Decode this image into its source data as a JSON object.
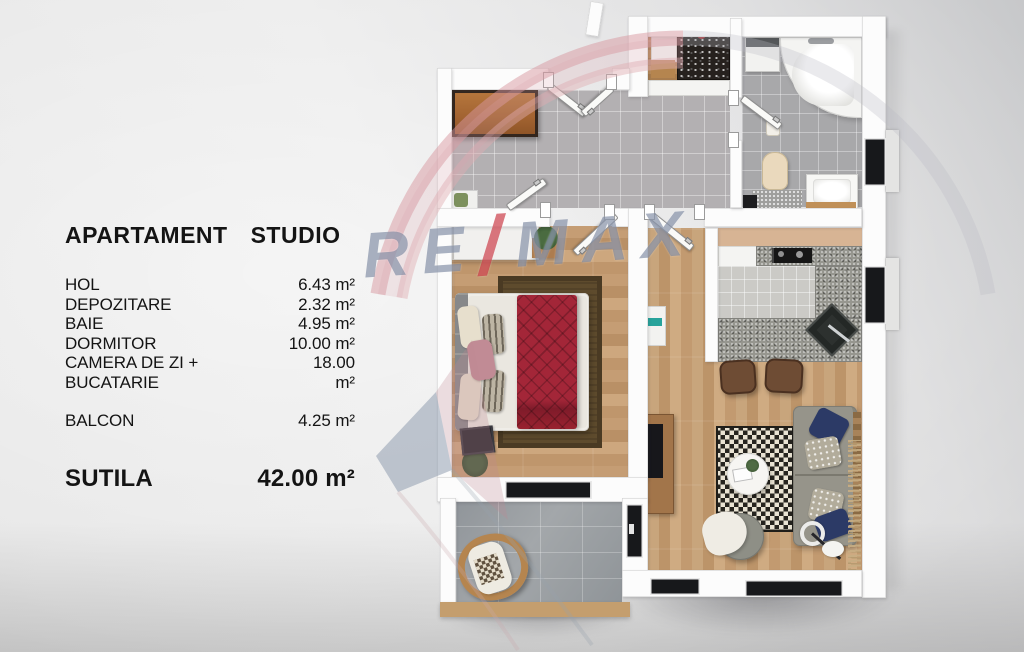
{
  "legend": {
    "title": {
      "word1": "APARTAMENT",
      "word2": "STUDIO"
    },
    "rooms": [
      {
        "name": "HOL",
        "area": "6.43 m²"
      },
      {
        "name": "DEPOZITARE",
        "area": "2.32 m²"
      },
      {
        "name": "BAIE",
        "area": "4.95 m²"
      },
      {
        "name": "DORMITOR",
        "area": "10.00 m²"
      },
      {
        "name": "CAMERA DE ZI + BUCATARIE",
        "area": "18.00 m²"
      }
    ],
    "balcony_row": {
      "name": "BALCON",
      "area": "4.25 m²"
    },
    "total_row": {
      "name": "SUTILA",
      "area": "42.00 m²"
    }
  },
  "watermark": {
    "part1": "RE",
    "slash": "/",
    "part2": "MAX"
  },
  "colors": {
    "watermark_blue": "#6c7a96",
    "watermark_red": "#c52532",
    "watermark_pink": "#d897a0",
    "bed_blanket_red": "#a32638",
    "wood_floor": "#c59d74",
    "hall_tile": "#b3b0b2",
    "balcony_tile": "#90959a",
    "kitchen_backsplash": "#d7b494",
    "text": "#141414"
  }
}
